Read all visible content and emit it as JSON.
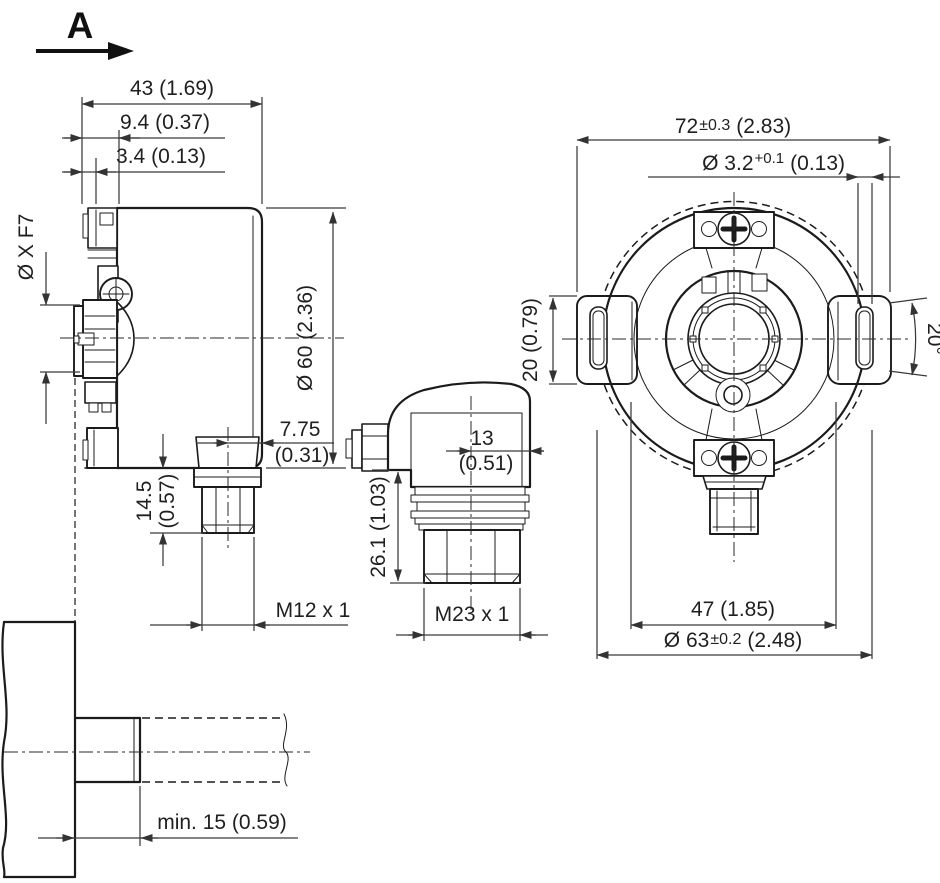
{
  "drawing": {
    "view_label": "A",
    "side_view": {
      "width": "43 (1.69)",
      "flange_offset": "9.4 (0.37)",
      "plate_offset": "3.4 (0.13)",
      "bore": "Ø X F7",
      "body_dia": "Ø 60 (2.36)",
      "m12_offset_mm": "7.75",
      "m12_offset_in": "(0.31)",
      "m12_length_mm": "14.5",
      "m12_length_in": "(0.57)",
      "m12_thread": "M12 x 1"
    },
    "cable_view": {
      "offset_mm": "13",
      "offset_in": "(0.51)",
      "height": "26.1 (1.03)",
      "thread": "M23 x 1"
    },
    "front_view": {
      "width_mm": "72",
      "width_tol": "±0.3",
      "width_in": "(2.83)",
      "pin_dia": "Ø 3.2",
      "pin_tol": "+0.1",
      "pin_in": "(0.13)",
      "tab_height": "20 (0.79)",
      "slot_angle": "20°",
      "pitch": "47 (1.85)",
      "outer_dia": "Ø 63",
      "outer_tol": "±0.2",
      "outer_in": "(2.48)"
    },
    "mounting_view": {
      "min_depth": "min. 15 (0.59)"
    }
  }
}
